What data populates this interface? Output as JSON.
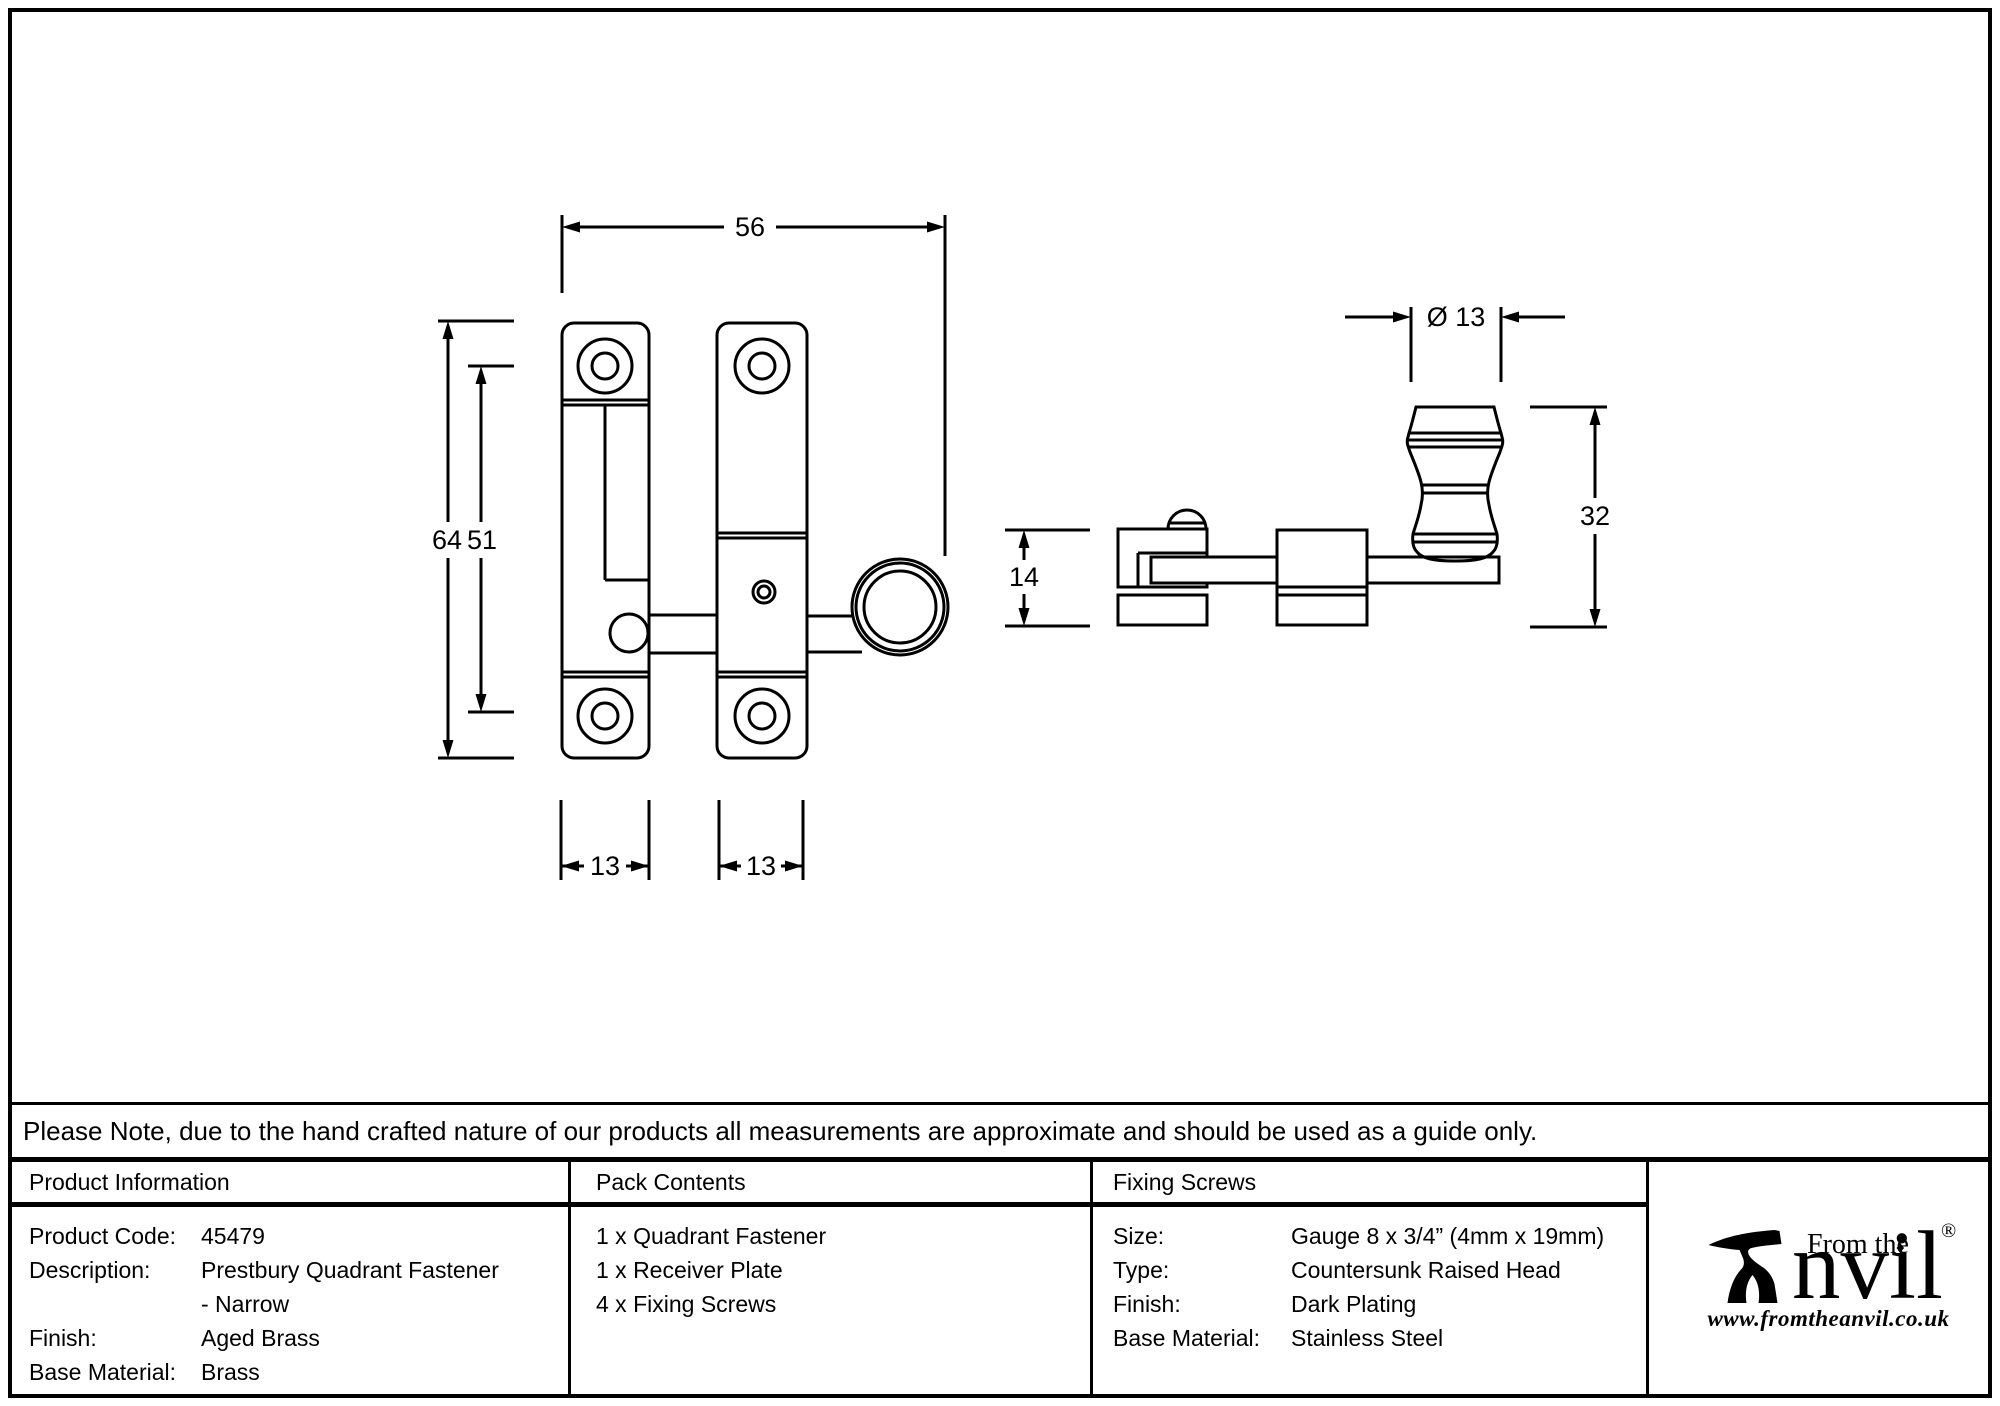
{
  "page": {
    "background": "#ffffff",
    "line_color": "#000000"
  },
  "drawing": {
    "front_view": {
      "width_mm": "56",
      "height_mm": "64",
      "hole_spacing_mm": "51",
      "plate_width_left_mm": "13",
      "plate_width_right_mm": "13"
    },
    "side_view": {
      "knob_diameter": "Ø 13",
      "depth_mm": "14",
      "height_mm": "32"
    }
  },
  "note": {
    "text": "Please Note, due to the hand crafted nature of our products all measurements are approximate and should be used as a guide only."
  },
  "table": {
    "product_information": {
      "header": "Product Information",
      "rows": [
        {
          "label": "Product Code:",
          "value": "45479"
        },
        {
          "label": "Description:",
          "value": "Prestbury Quadrant Fastener"
        },
        {
          "label": "",
          "value": "- Narrow"
        },
        {
          "label": "Finish:",
          "value": "Aged Brass"
        },
        {
          "label": "Base Material:",
          "value": "Brass"
        }
      ]
    },
    "pack_contents": {
      "header": "Pack Contents",
      "items": [
        "1 x Quadrant Fastener",
        "1 x Receiver Plate",
        "4 x Fixing Screws"
      ]
    },
    "fixing_screws": {
      "header": "Fixing Screws",
      "rows": [
        {
          "label": "Size:",
          "value": "Gauge 8 x 3/4” (4mm x 19mm)"
        },
        {
          "label": "Type:",
          "value": "Countersunk Raised Head"
        },
        {
          "label": "Finish:",
          "value": "Dark Plating"
        },
        {
          "label": "Base Material:",
          "value": "Stainless Steel"
        }
      ]
    }
  },
  "logo": {
    "prefix": "From the",
    "brand": "nvil",
    "registered": "®",
    "diamond": "♦",
    "website": "www.fromtheanvil.co.uk"
  }
}
